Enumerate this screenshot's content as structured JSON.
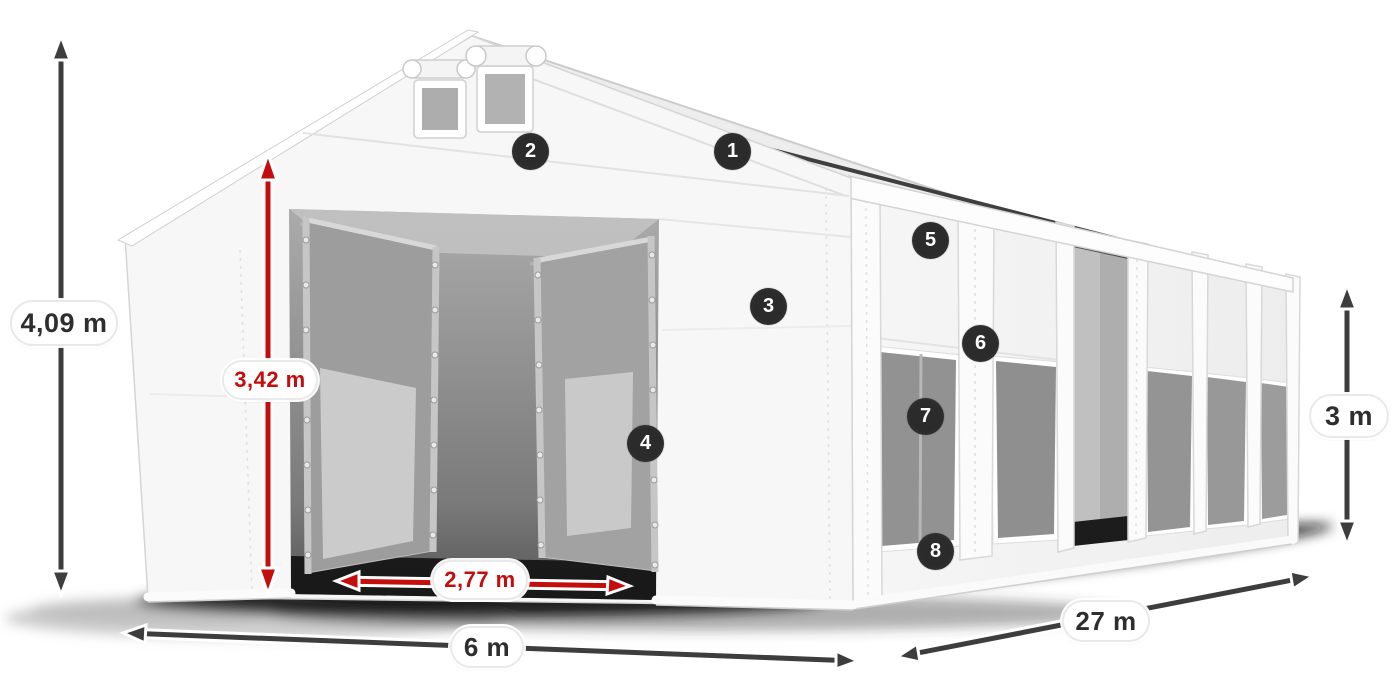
{
  "dimensions": {
    "total_height": {
      "label": "4,09 m"
    },
    "door_height": {
      "label": "3,42 m"
    },
    "door_width": {
      "label": "2,77 m"
    },
    "front_width": {
      "label": "6 m"
    },
    "side_length": {
      "label": "27 m"
    },
    "side_height": {
      "label": "3 m"
    }
  },
  "callouts": [
    {
      "number": "1"
    },
    {
      "number": "2"
    },
    {
      "number": "3"
    },
    {
      "number": "4"
    },
    {
      "number": "5"
    },
    {
      "number": "6"
    },
    {
      "number": "7"
    },
    {
      "number": "8"
    }
  ],
  "colors": {
    "background": "#ffffff",
    "dimension_dark": "#3d3d3d",
    "dimension_red": "#c40d0d",
    "badge_background": "#2b2b2b",
    "badge_text": "#ffffff",
    "tent_white": "#f7f7f7",
    "mesh_gray": "#949494"
  }
}
